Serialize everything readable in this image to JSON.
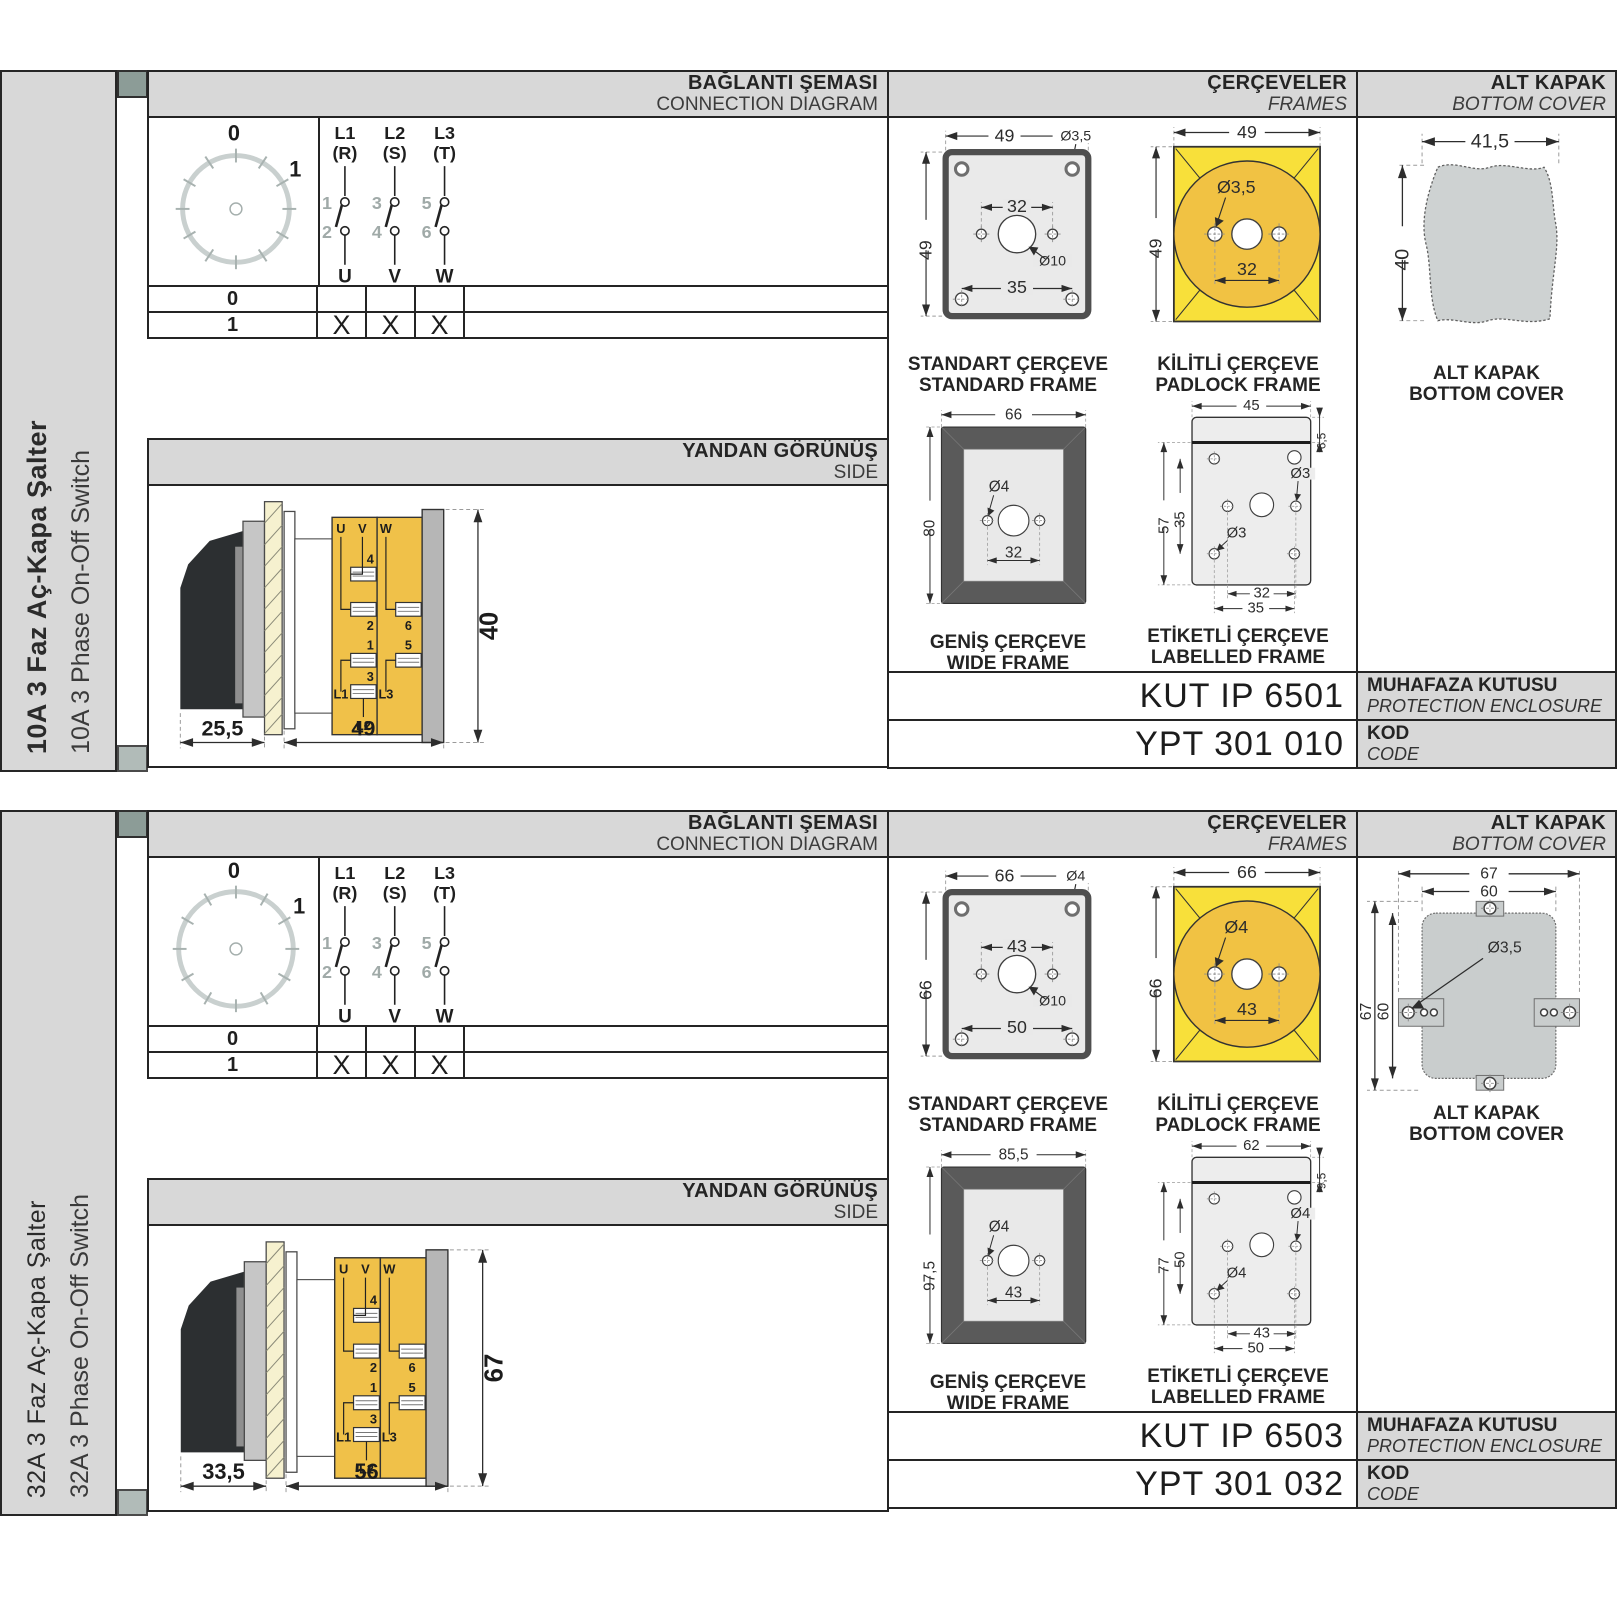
{
  "colors": {
    "accent_yellow": "#f8e03a",
    "amber": "#f0c149",
    "panel_gray": "#d8d8d8"
  },
  "panels": [
    {
      "sidebar": {
        "title_tr": "10A 3 Faz Aç-Kapa Şalter",
        "title_en": "10A 3 Phase On-Off Switch"
      },
      "headers": {
        "connection_tr": "BAĞLANTI ŞEMASI",
        "connection_en": "CONNECTION DIAGRAM",
        "frames_tr": "ÇERÇEVELER",
        "frames_en": "FRAMES",
        "cover_tr": "ALT KAPAK",
        "cover_en": "BOTTOM COVER",
        "side_tr": "YANDAN GÖRÜNÜŞ",
        "side_en": "SIDE"
      },
      "dial": {
        "pos_off": "0",
        "pos_on": "1"
      },
      "contacts": {
        "phases": [
          {
            "name": "L1",
            "alt": "(R)",
            "top": "1",
            "bottom": "2",
            "term": "U"
          },
          {
            "name": "L2",
            "alt": "(S)",
            "top": "3",
            "bottom": "4",
            "term": "V"
          },
          {
            "name": "L3",
            "alt": "(T)",
            "top": "5",
            "bottom": "6",
            "term": "W"
          }
        ]
      },
      "truth_table": {
        "rows": [
          {
            "label": "0",
            "cells": [
              "",
              "",
              ""
            ]
          },
          {
            "label": "1",
            "cells": [
              "X",
              "X",
              "X"
            ]
          }
        ]
      },
      "side_view": {
        "dim_depth": "25,5",
        "dim_width": "49",
        "dim_height": "40",
        "labels": {
          "u": "U",
          "v": "V",
          "w": "W",
          "t1": "1",
          "t2": "2",
          "t3": "3",
          "t4": "4",
          "t5": "5",
          "t6": "6",
          "l1": "L1",
          "l2": "L2",
          "l3": "L3"
        }
      },
      "frames": {
        "standard": {
          "cap_tr": "STANDART ÇERÇEVE",
          "cap_en": "STANDARD FRAME",
          "w": "49",
          "h": "49",
          "hole": "Ø3,5",
          "span_inner": "32",
          "knob": "Ø10",
          "span_outer": "35"
        },
        "padlock": {
          "cap_tr": "KİLİTLİ ÇERÇEVE",
          "cap_en": "PADLOCK FRAME",
          "w": "49",
          "h": "49",
          "hole": "Ø3,5",
          "span": "32"
        },
        "wide": {
          "cap_tr": "GENİŞ ÇERÇEVE",
          "cap_en": "WIDE FRAME",
          "w": "66",
          "h": "80",
          "hole": "Ø4",
          "span": "32"
        },
        "labelled": {
          "cap_tr": "ETİKETLİ ÇERÇEVE",
          "cap_en": "LABELLED FRAME",
          "w": "45",
          "strip": "6,5",
          "h": "57",
          "inner_h": "35",
          "hole_a": "Ø3",
          "hole_b": "Ø3",
          "span_inner": "32",
          "span_outer": "35"
        }
      },
      "cover": {
        "cap_tr": "ALT KAPAK",
        "cap_en": "BOTTOM COVER",
        "w": "41,5",
        "h": "40"
      },
      "codes": {
        "enclosure_value": "KUT IP 6501",
        "enclosure_tr": "MUHAFAZA KUTUSU",
        "enclosure_en": "PROTECTION ENCLOSURE",
        "code_value": "YPT 301 010",
        "code_tr": "KOD",
        "code_en": "CODE"
      }
    },
    {
      "sidebar": {
        "title_tr": "32A 3 Faz Aç-Kapa Şalter",
        "title_en": "32A 3 Phase On-Off Switch"
      },
      "headers": {
        "connection_tr": "BAĞLANTI ŞEMASI",
        "connection_en": "CONNECTION DIAGRAM",
        "frames_tr": "ÇERÇEVELER",
        "frames_en": "FRAMES",
        "cover_tr": "ALT KAPAK",
        "cover_en": "BOTTOM COVER",
        "side_tr": "YANDAN GÖRÜNÜŞ",
        "side_en": "SIDE"
      },
      "dial": {
        "pos_off": "0",
        "pos_on": "1"
      },
      "contacts": {
        "phases": [
          {
            "name": "L1",
            "alt": "(R)",
            "top": "1",
            "bottom": "2",
            "term": "U"
          },
          {
            "name": "L2",
            "alt": "(S)",
            "top": "3",
            "bottom": "4",
            "term": "V"
          },
          {
            "name": "L3",
            "alt": "(T)",
            "top": "5",
            "bottom": "6",
            "term": "W"
          }
        ]
      },
      "truth_table": {
        "rows": [
          {
            "label": "0",
            "cells": [
              "",
              "",
              ""
            ]
          },
          {
            "label": "1",
            "cells": [
              "X",
              "X",
              "X"
            ]
          }
        ]
      },
      "side_view": {
        "dim_depth": "33,5",
        "dim_width": "56",
        "dim_height": "67",
        "labels": {
          "u": "U",
          "v": "V",
          "w": "W",
          "t1": "1",
          "t2": "2",
          "t3": "3",
          "t4": "4",
          "t5": "5",
          "t6": "6",
          "l1": "L1",
          "l2": "L2",
          "l3": "L3"
        }
      },
      "frames": {
        "standard": {
          "cap_tr": "STANDART ÇERÇEVE",
          "cap_en": "STANDARD FRAME",
          "w": "66",
          "h": "66",
          "hole": "Ø4",
          "span_inner": "43",
          "knob": "Ø10",
          "span_outer": "50"
        },
        "padlock": {
          "cap_tr": "KİLİTLİ ÇERÇEVE",
          "cap_en": "PADLOCK FRAME",
          "w": "66",
          "h": "66",
          "hole": "Ø4",
          "span": "43"
        },
        "wide": {
          "cap_tr": "GENİŞ ÇERÇEVE",
          "cap_en": "WIDE FRAME",
          "w": "85,5",
          "h": "97,5",
          "hole": "Ø4",
          "span": "43"
        },
        "labelled": {
          "cap_tr": "ETİKETLİ ÇERÇEVE",
          "cap_en": "LABELLED FRAME",
          "w": "62",
          "strip": "9,5",
          "h": "77",
          "inner_h": "50",
          "hole_a": "Ø4",
          "hole_b": "Ø4",
          "span_inner": "43",
          "span_outer": "50"
        }
      },
      "cover": {
        "cap_tr": "ALT KAPAK",
        "cap_en": "BOTTOM COVER",
        "top_outer": "67",
        "top_inner": "60",
        "left_outer": "67",
        "left_inner": "60",
        "hole": "Ø3,5"
      },
      "codes": {
        "enclosure_value": "KUT IP 6503",
        "enclosure_tr": "MUHAFAZA KUTUSU",
        "enclosure_en": "PROTECTION ENCLOSURE",
        "code_value": "YPT 301 032",
        "code_tr": "KOD",
        "code_en": "CODE"
      }
    }
  ]
}
